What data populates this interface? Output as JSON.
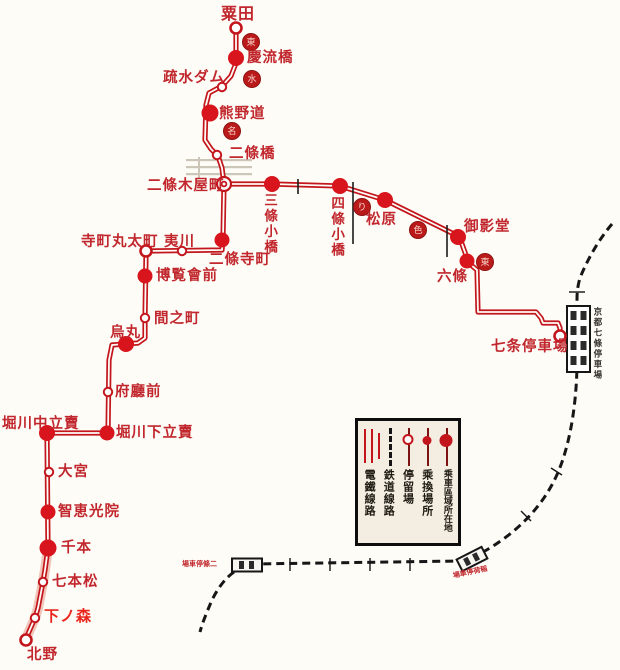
{
  "colors": {
    "background": "#fdfcf7",
    "tram_line": "#c3161c",
    "station_fill": "#d8151c",
    "label_red": "#c1272d",
    "label_bright_red": "#ea251c",
    "rail_black": "#161616",
    "bridge_gray": "#ccc6b8",
    "band_pink": "#f2c3b8",
    "marker_fill": "#bb1a1a"
  },
  "legend": {
    "items": [
      {
        "icon": "tram-double-line-icon",
        "label": "電鐵線路"
      },
      {
        "icon": "railway-dashed-line-icon",
        "label": "鉄道線路"
      },
      {
        "icon": "stop-open-circle-icon",
        "label": "停留場"
      },
      {
        "icon": "transfer-small-circle-icon",
        "label": "乘換場所"
      },
      {
        "icon": "zone-large-circle-icon",
        "label": "乘車區域所在地"
      }
    ]
  },
  "stations": [
    {
      "id": "awata",
      "label": "粟田",
      "x": 236,
      "y": 28,
      "type": "ring",
      "lx": 221,
      "ly": 6,
      "fs": 16
    },
    {
      "id": "keiryubashi",
      "label": "慶流橋",
      "x": 236,
      "y": 58,
      "type": "filled",
      "r": 8,
      "lx": 247,
      "ly": 50
    },
    {
      "id": "sosui-dam",
      "label": "疏水ダム",
      "x": 222,
      "y": 87,
      "type": "open",
      "lx": 163,
      "ly": 70
    },
    {
      "id": "kumanomichi",
      "label": "熊野道",
      "x": 210,
      "y": 113,
      "type": "filled",
      "r": 8.5,
      "lx": 219,
      "ly": 106
    },
    {
      "id": "nijobashi",
      "label": "二條橋",
      "x": 217,
      "y": 155,
      "type": "open",
      "lx": 229,
      "ly": 146
    },
    {
      "id": "nijo-kiyamachi",
      "label": "二條木屋町",
      "x": 224,
      "y": 184,
      "type": "junction",
      "lx": 147,
      "ly": 178
    },
    {
      "id": "sanjo-kobashi",
      "label": "三條小橋",
      "x": 272,
      "y": 184,
      "type": "filled",
      "r": 8,
      "lx": 262,
      "ly": 193,
      "orient": "vert",
      "fs": 13.5
    },
    {
      "id": "shijo-kobashi",
      "label": "四條小橋",
      "x": 340,
      "y": 186,
      "type": "filled",
      "r": 8,
      "lx": 329,
      "ly": 196,
      "orient": "vert",
      "fs": 13.5
    },
    {
      "id": "matsubara",
      "label": "松原",
      "x": 385,
      "y": 200,
      "type": "filled",
      "r": 8,
      "lx": 366,
      "ly": 212
    },
    {
      "id": "mieido",
      "label": "御影堂",
      "x": 458,
      "y": 237,
      "type": "filled",
      "r": 8,
      "lx": 464,
      "ly": 219
    },
    {
      "id": "rokujo",
      "label": "六條",
      "x": 467,
      "y": 261,
      "type": "filled",
      "r": 7.5,
      "lx": 437,
      "ly": 269
    },
    {
      "id": "shichijo-teishajo",
      "label": "七条停車場",
      "x": 560,
      "y": 336,
      "type": "ring",
      "lx": 491,
      "ly": 339
    },
    {
      "id": "nijo-teramachi",
      "label": "二條寺町",
      "x": 222,
      "y": 240,
      "type": "filled",
      "r": 7.5,
      "lx": 209,
      "ly": 252
    },
    {
      "id": "teramachi-marutamachi",
      "label": "寺町丸太町",
      "x": 146,
      "y": 251,
      "type": "ring",
      "lx": 81,
      "ly": 234
    },
    {
      "id": "ebisugawa",
      "label": "夷川",
      "x": 182,
      "y": 251,
      "type": "open",
      "lx": 164,
      "ly": 234
    },
    {
      "id": "hakurankai-mae",
      "label": "博覧會前",
      "x": 145,
      "y": 276,
      "type": "filled",
      "r": 7.5,
      "lx": 156,
      "ly": 268
    },
    {
      "id": "ainomachi",
      "label": "間之町",
      "x": 145,
      "y": 318,
      "type": "open",
      "lx": 154,
      "ly": 311
    },
    {
      "id": "karasuma",
      "label": "烏丸",
      "x": 126,
      "y": 344,
      "type": "filled",
      "r": 8,
      "lx": 110,
      "ly": 325
    },
    {
      "id": "fucho-mae",
      "label": "府廳前",
      "x": 108,
      "y": 392,
      "type": "open",
      "lx": 115,
      "ly": 384
    },
    {
      "id": "horikawa-nakadachiuri",
      "label": "堀川中立賣",
      "x": 47,
      "y": 433,
      "type": "filled",
      "r": 8,
      "lx": 2,
      "ly": 416
    },
    {
      "id": "horikawa-shimodachiuri",
      "label": "堀川下立賣",
      "x": 107,
      "y": 433,
      "type": "filled",
      "r": 7.5,
      "lx": 116,
      "ly": 425
    },
    {
      "id": "omiya",
      "label": "大宮",
      "x": 49,
      "y": 472,
      "type": "open",
      "lx": 58,
      "ly": 464
    },
    {
      "id": "chiekoin",
      "label": "智恵光院",
      "x": 48,
      "y": 512,
      "type": "filled",
      "r": 7.5,
      "lx": 58,
      "ly": 504
    },
    {
      "id": "senbon",
      "label": "千本",
      "x": 48,
      "y": 548,
      "type": "filled",
      "r": 8.5,
      "lx": 61,
      "ly": 540
    },
    {
      "id": "shichihonmatsu",
      "label": "七本松",
      "x": 43,
      "y": 582,
      "type": "open",
      "lx": 52,
      "ly": 574
    },
    {
      "id": "shimonomori",
      "label": "下ノ森",
      "x": 35,
      "y": 618,
      "type": "open",
      "lx": 44,
      "ly": 609,
      "fs": 15,
      "bright": true
    },
    {
      "id": "kitano",
      "label": "北野",
      "x": 26,
      "y": 640,
      "type": "ring",
      "lx": 27,
      "ly": 647
    }
  ],
  "zone_markers": [
    {
      "x": 251,
      "y": 42,
      "glyph": "東"
    },
    {
      "x": 252,
      "y": 79,
      "glyph": "水"
    },
    {
      "x": 232,
      "y": 131,
      "glyph": "名"
    },
    {
      "x": 362,
      "y": 207,
      "glyph": "り"
    },
    {
      "x": 418,
      "y": 230,
      "glyph": "色"
    },
    {
      "x": 485,
      "y": 262,
      "glyph": "東"
    }
  ],
  "map": {
    "tram_paths": [
      {
        "name": "tram-line-west",
        "points": [
          [
            236,
            28
          ],
          [
            236,
            63
          ],
          [
            231,
            76
          ],
          [
            222,
            86
          ],
          [
            209,
            93
          ],
          [
            206,
            105
          ],
          [
            205,
            140
          ],
          [
            211,
            149
          ],
          [
            218,
            156
          ],
          [
            222,
            168
          ],
          [
            224,
            184
          ],
          [
            223,
            238
          ],
          [
            222,
            250
          ],
          [
            148,
            251
          ],
          [
            146,
            255
          ],
          [
            145,
            318
          ],
          [
            145,
            338
          ],
          [
            138,
            343
          ],
          [
            112,
            345
          ],
          [
            109,
            360
          ],
          [
            108,
            433
          ],
          [
            47,
            433
          ],
          [
            48,
            548
          ],
          [
            45,
            570
          ],
          [
            43,
            582
          ],
          [
            38,
            608
          ],
          [
            35,
            618
          ],
          [
            28,
            634
          ],
          [
            26,
            641
          ]
        ]
      },
      {
        "name": "tram-line-east",
        "points": [
          [
            224,
            184
          ],
          [
            272,
            184
          ],
          [
            340,
            186
          ],
          [
            385,
            200
          ],
          [
            458,
            236
          ],
          [
            462,
            244
          ],
          [
            467,
            258
          ],
          [
            471,
            265
          ],
          [
            477,
            270
          ],
          [
            478,
            312
          ],
          [
            536,
            312
          ],
          [
            541,
            318
          ],
          [
            543,
            323
          ],
          [
            558,
            323
          ],
          [
            560,
            328
          ],
          [
            560,
            335
          ]
        ]
      }
    ],
    "pink_band": [
      [
        48,
        548
      ],
      [
        45,
        570
      ],
      [
        43,
        582
      ],
      [
        38,
        608
      ],
      [
        35,
        618
      ],
      [
        28,
        634
      ],
      [
        26,
        641
      ]
    ],
    "rail_path": "M 612,224 C 600,238 588,258 580,278 C 577,288 577,295 577,300 L 577,368 C 576,404 571,436 562,462 C 551,494 530,520 502,540 C 488,550 475,557 462,561 L 252,564 C 233,568 221,582 212,600 C 206,614 202,624 200,632",
    "rail_ticks": [
      [
        290,
        558,
        290,
        571
      ],
      [
        330,
        558,
        330,
        571
      ],
      [
        370,
        558,
        370,
        571
      ],
      [
        410,
        558,
        410,
        571
      ],
      [
        521,
        511,
        531,
        521
      ],
      [
        551,
        468,
        562,
        475
      ],
      [
        569,
        292,
        585,
        292
      ]
    ],
    "black_ticks": [
      [
        298,
        179,
        298,
        194
      ],
      [
        353,
        182,
        353,
        244
      ],
      [
        447,
        225,
        447,
        257
      ]
    ],
    "bridge_bars": [
      [
        186,
        159,
        66,
        2.2
      ],
      [
        186,
        166,
        66,
        2.2
      ],
      [
        186,
        173,
        66,
        2.2
      ],
      [
        198,
        157,
        2,
        21
      ]
    ],
    "rail_station_big": {
      "x": 567,
      "y": 306,
      "w": 23,
      "h": 66
    },
    "rail_box_a": {
      "cx": 247,
      "cy": 565,
      "w": 30,
      "h": 13,
      "rot": 0
    },
    "rail_box_b": {
      "cx": 472,
      "cy": 559,
      "w": 28,
      "h": 13,
      "rot": -27
    }
  },
  "extra_labels": [
    {
      "id": "kyoto-shichijo-station-name",
      "label": "京都七條停車場",
      "x": 592,
      "y": 307,
      "orient": "vert",
      "fs": 8.5,
      "color": "#33302a"
    },
    {
      "id": "rail-box-a-label",
      "label": "場車停條二",
      "x": 182,
      "y": 559,
      "fs": 7,
      "tiny": true,
      "rot": 0
    },
    {
      "id": "rail-box-b-label",
      "label": "場車停荷稲",
      "x": 452,
      "y": 571,
      "fs": 7,
      "tiny": true,
      "rot": -12
    }
  ]
}
